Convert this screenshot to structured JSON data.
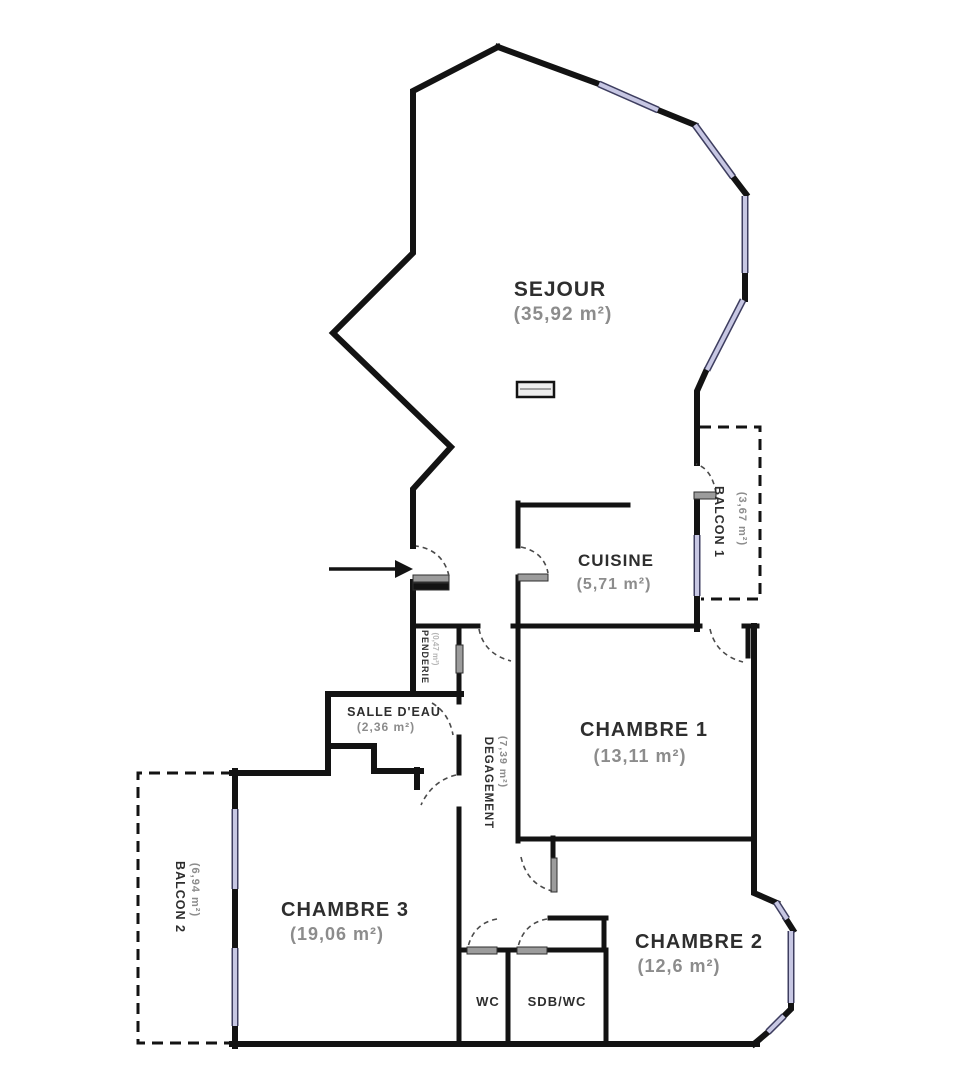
{
  "plan": {
    "type": "apartment-floor-plan",
    "rooms": {
      "sejour": {
        "name": "SEJOUR",
        "area": "(35,92 m²)"
      },
      "cuisine": {
        "name": "CUISINE",
        "area": "(5,71 m²)"
      },
      "chambre1": {
        "name": "CHAMBRE 1",
        "area": "(13,11 m²)"
      },
      "chambre2": {
        "name": "CHAMBRE 2",
        "area": "(12,6 m²)"
      },
      "chambre3": {
        "name": "CHAMBRE 3",
        "area": "(19,06 m²)"
      },
      "salle_eau": {
        "name": "SALLE D'EAU",
        "area": "(2,36 m²)"
      },
      "degagement": {
        "name": "DEGAGEMENT",
        "area": "(7,39 m²)"
      },
      "penderie": {
        "name": "PENDERIE",
        "area": "(0,47 m²)"
      },
      "balcon1": {
        "name": "BALCON 1",
        "area": "(3,67 m²)"
      },
      "balcon2": {
        "name": "BALCON 2",
        "area": "(6,94 m²)"
      },
      "wc": {
        "name": "WC"
      },
      "sdb": {
        "name": "SDB/WC"
      }
    },
    "colors": {
      "wall": "#131313",
      "window_fill": "#c7c7e3",
      "window_edge": "#3e3e60",
      "door_leaf": "#9c9c9c",
      "room_name": "#2e2e2e",
      "room_area": "#8c8c8c"
    }
  }
}
